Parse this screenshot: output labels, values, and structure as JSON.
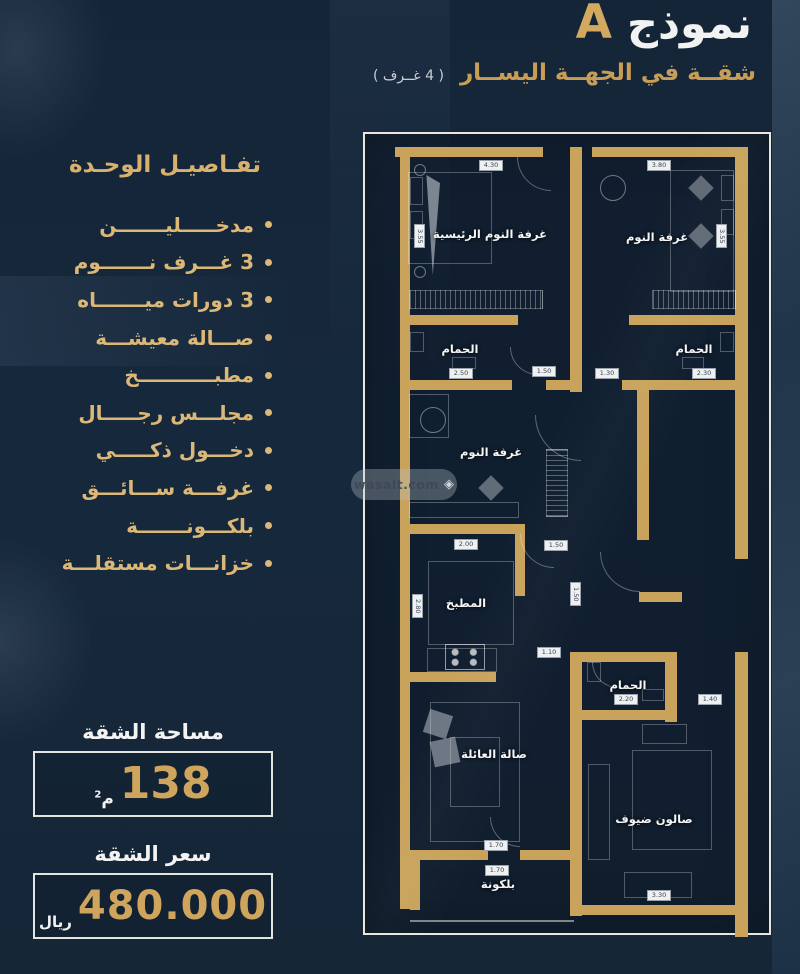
{
  "header": {
    "title_model": "نموذج",
    "title_letter": "A",
    "subtitle": "شقــة في الجهــة اليســار",
    "subtitle_note": "( 4 غــرف )"
  },
  "details": {
    "heading": "تفـاصيـل الوحـدة",
    "items": [
      "مدخـــــليـــــــن",
      "3 غـــرف نـــــــوم",
      "3 دورات ميـــــــاه",
      "صـــالة معيشـــة",
      "مطبـــــــــــخ",
      "مجلـــس رجـــــال",
      "دخـــول ذكـــــي",
      "غرفـــة ســـائـــق",
      "بلكـــونـــــــة",
      "خزانـــات مستقلـــة"
    ]
  },
  "area": {
    "heading": "مساحة الشقة",
    "value": "138",
    "unit": "م",
    "unit_sup": "2"
  },
  "price": {
    "heading": "سعر الشقة",
    "value": "480.000",
    "currency": "ريال"
  },
  "watermark": {
    "text": "wasalt.com",
    "diamond": "◈"
  },
  "colors": {
    "background": "#16283c",
    "accent_gold": "#d2a95f",
    "wall_gold": "#c9a35c",
    "list_gold": "#dcb878",
    "text_white": "#f2f2f2"
  },
  "floorplan": {
    "rooms": [
      {
        "id": "master-bedroom",
        "label": "غرفة النوم الرئيسية",
        "x": 125,
        "y": 100
      },
      {
        "id": "bedroom-2",
        "label": "غرفة النوم",
        "x": 292,
        "y": 103
      },
      {
        "id": "bathroom-1",
        "label": "الحمام",
        "x": 95,
        "y": 215
      },
      {
        "id": "bathroom-2",
        "label": "الحمام",
        "x": 329,
        "y": 215
      },
      {
        "id": "bedroom-3",
        "label": "غرفة النوم",
        "x": 126,
        "y": 318
      },
      {
        "id": "kitchen",
        "label": "المطبخ",
        "x": 101,
        "y": 469
      },
      {
        "id": "family-hall",
        "label": "صالة العائلة",
        "x": 129,
        "y": 620
      },
      {
        "id": "bathroom-3",
        "label": "الحمام",
        "x": 263,
        "y": 551
      },
      {
        "id": "guest-salon",
        "label": "صالون ضيوف",
        "x": 289,
        "y": 685
      },
      {
        "id": "balcony",
        "label": "بلكونة",
        "x": 133,
        "y": 750
      }
    ],
    "walls": [
      [
        30,
        13,
        148,
        10
      ],
      [
        227,
        13,
        153,
        10
      ],
      [
        35,
        13,
        10,
        762
      ],
      [
        370,
        13,
        13,
        412
      ],
      [
        370,
        518,
        13,
        285
      ],
      [
        205,
        13,
        12,
        245
      ],
      [
        35,
        181,
        118,
        10
      ],
      [
        264,
        181,
        116,
        10
      ],
      [
        35,
        246,
        112,
        10
      ],
      [
        181,
        246,
        36,
        10
      ],
      [
        257,
        246,
        126,
        10
      ],
      [
        272,
        256,
        12,
        150
      ],
      [
        35,
        390,
        118,
        10
      ],
      [
        150,
        390,
        10,
        72
      ],
      [
        35,
        538,
        96,
        10
      ],
      [
        274,
        458,
        43,
        10
      ],
      [
        205,
        518,
        12,
        264
      ],
      [
        205,
        518,
        107,
        10
      ],
      [
        300,
        518,
        12,
        70
      ],
      [
        217,
        576,
        95,
        10
      ],
      [
        214,
        771,
        169,
        10
      ],
      [
        45,
        716,
        78,
        10
      ],
      [
        155,
        716,
        62,
        10
      ],
      [
        45,
        716,
        10,
        60
      ]
    ],
    "dimensions": [
      {
        "label": "4.30",
        "x": 114,
        "y": 26
      },
      {
        "label": "3.80",
        "x": 282,
        "y": 26
      },
      {
        "label": "3.55",
        "x": 49,
        "y": 90,
        "v": true
      },
      {
        "label": "3.55",
        "x": 351,
        "y": 90,
        "v": true
      },
      {
        "label": "2.50",
        "x": 84,
        "y": 234
      },
      {
        "label": "1.50",
        "x": 167,
        "y": 232
      },
      {
        "label": "1.30",
        "x": 230,
        "y": 234
      },
      {
        "label": "2.30",
        "x": 327,
        "y": 234
      },
      {
        "label": "2.00",
        "x": 89,
        "y": 405
      },
      {
        "label": "1.50",
        "x": 179,
        "y": 406
      },
      {
        "label": "1.50",
        "x": 205,
        "y": 448,
        "v": true
      },
      {
        "label": "2.80",
        "x": 47,
        "y": 460,
        "v": true
      },
      {
        "label": "1.10",
        "x": 172,
        "y": 513
      },
      {
        "label": "2.20",
        "x": 249,
        "y": 560
      },
      {
        "label": "1.40",
        "x": 333,
        "y": 560
      },
      {
        "label": "1.70",
        "x": 119,
        "y": 706
      },
      {
        "label": "1.70",
        "x": 120,
        "y": 731
      },
      {
        "label": "3.30",
        "x": 282,
        "y": 756
      }
    ],
    "furniture": [
      {
        "t": "rect",
        "n": "bed",
        "x": 43,
        "y": 38,
        "w": 84,
        "h": 92
      },
      {
        "t": "rect",
        "n": "pillow",
        "x": 45,
        "y": 43,
        "w": 13,
        "h": 28
      },
      {
        "t": "rect",
        "n": "pillow",
        "x": 45,
        "y": 77,
        "w": 13,
        "h": 28
      },
      {
        "t": "wedge",
        "n": "drape",
        "x": 59,
        "y": 41,
        "w": 16,
        "h": 100
      },
      {
        "t": "hatch",
        "n": "wardrobe",
        "x": 44,
        "y": 156,
        "w": 134,
        "h": 19
      },
      {
        "t": "circle",
        "n": "ceiling-lamp",
        "x": 49,
        "y": 30,
        "w": 12,
        "h": 12
      },
      {
        "t": "circle",
        "n": "ceiling-lamp",
        "x": 49,
        "y": 132,
        "w": 12,
        "h": 12
      },
      {
        "t": "rect",
        "n": "bed",
        "x": 305,
        "y": 36,
        "w": 64,
        "h": 122
      },
      {
        "t": "rect",
        "n": "pillow",
        "x": 356,
        "y": 41,
        "w": 13,
        "h": 26
      },
      {
        "t": "rect",
        "n": "pillow",
        "x": 356,
        "y": 75,
        "w": 13,
        "h": 26
      },
      {
        "t": "circle",
        "n": "ceiling-fan",
        "x": 235,
        "y": 41,
        "w": 26,
        "h": 26
      },
      {
        "t": "diamond",
        "n": "decor-star",
        "x": 327,
        "y": 45,
        "w": 18,
        "h": 18
      },
      {
        "t": "diamond",
        "n": "decor-star",
        "x": 327,
        "y": 93,
        "w": 18,
        "h": 18
      },
      {
        "t": "hatch",
        "n": "wardrobe",
        "x": 287,
        "y": 156,
        "w": 84,
        "h": 19
      },
      {
        "t": "rect",
        "n": "toilet",
        "x": 45,
        "y": 198,
        "w": 14,
        "h": 20
      },
      {
        "t": "rect",
        "n": "sink",
        "x": 87,
        "y": 223,
        "w": 24,
        "h": 12
      },
      {
        "t": "rect",
        "n": "toilet",
        "x": 355,
        "y": 198,
        "w": 14,
        "h": 20
      },
      {
        "t": "rect",
        "n": "sink",
        "x": 317,
        "y": 223,
        "w": 22,
        "h": 12
      },
      {
        "t": "rect",
        "n": "closet",
        "x": 44,
        "y": 260,
        "w": 40,
        "h": 44
      },
      {
        "t": "circle",
        "n": "ceiling-fan",
        "x": 55,
        "y": 273,
        "w": 26,
        "h": 26
      },
      {
        "t": "diamond",
        "n": "decor-star",
        "x": 117,
        "y": 345,
        "w": 18,
        "h": 18
      },
      {
        "t": "hatchv",
        "n": "wardrobe",
        "x": 181,
        "y": 315,
        "w": 22,
        "h": 68
      },
      {
        "t": "rect",
        "n": "vanity-counter",
        "x": 44,
        "y": 368,
        "w": 110,
        "h": 16
      },
      {
        "t": "rect",
        "n": "kitchen-counter",
        "x": 63,
        "y": 427,
        "w": 86,
        "h": 84
      },
      {
        "t": "rect",
        "n": "kitchen-counter",
        "x": 62,
        "y": 514,
        "w": 70,
        "h": 24
      },
      {
        "t": "stove",
        "n": "stove",
        "x": 80,
        "y": 510,
        "w": 40,
        "h": 26
      },
      {
        "t": "rect",
        "n": "sofa",
        "x": 65,
        "y": 568,
        "w": 90,
        "h": 140
      },
      {
        "t": "rect",
        "n": "coffee-table",
        "x": 85,
        "y": 603,
        "w": 50,
        "h": 70
      },
      {
        "t": "solid",
        "n": "plant",
        "x": 61,
        "y": 578,
        "w": 24,
        "h": 24,
        "r": 18
      },
      {
        "t": "solid",
        "n": "plant",
        "x": 67,
        "y": 605,
        "w": 26,
        "h": 26,
        "r": -12
      },
      {
        "t": "rect",
        "n": "toilet",
        "x": 222,
        "y": 528,
        "w": 14,
        "h": 20
      },
      {
        "t": "rect",
        "n": "sink",
        "x": 277,
        "y": 555,
        "w": 22,
        "h": 12
      },
      {
        "t": "rect",
        "n": "rug",
        "x": 267,
        "y": 616,
        "w": 80,
        "h": 100
      },
      {
        "t": "rect",
        "n": "sofa",
        "x": 223,
        "y": 630,
        "w": 22,
        "h": 96
      },
      {
        "t": "rect",
        "n": "sofa",
        "x": 259,
        "y": 738,
        "w": 68,
        "h": 26
      },
      {
        "t": "rect",
        "n": "sofa",
        "x": 277,
        "y": 590,
        "w": 45,
        "h": 20
      }
    ],
    "arcs": [
      {
        "x": 152,
        "y": 23,
        "s": 34
      },
      {
        "x": 145,
        "y": 213,
        "s": 28
      },
      {
        "x": 170,
        "y": 281,
        "s": 46
      },
      {
        "x": 155,
        "y": 400,
        "s": 34
      },
      {
        "x": 235,
        "y": 418,
        "s": 40
      },
      {
        "x": 227,
        "y": 528,
        "s": 26
      },
      {
        "x": 125,
        "y": 683,
        "s": 30
      }
    ]
  }
}
